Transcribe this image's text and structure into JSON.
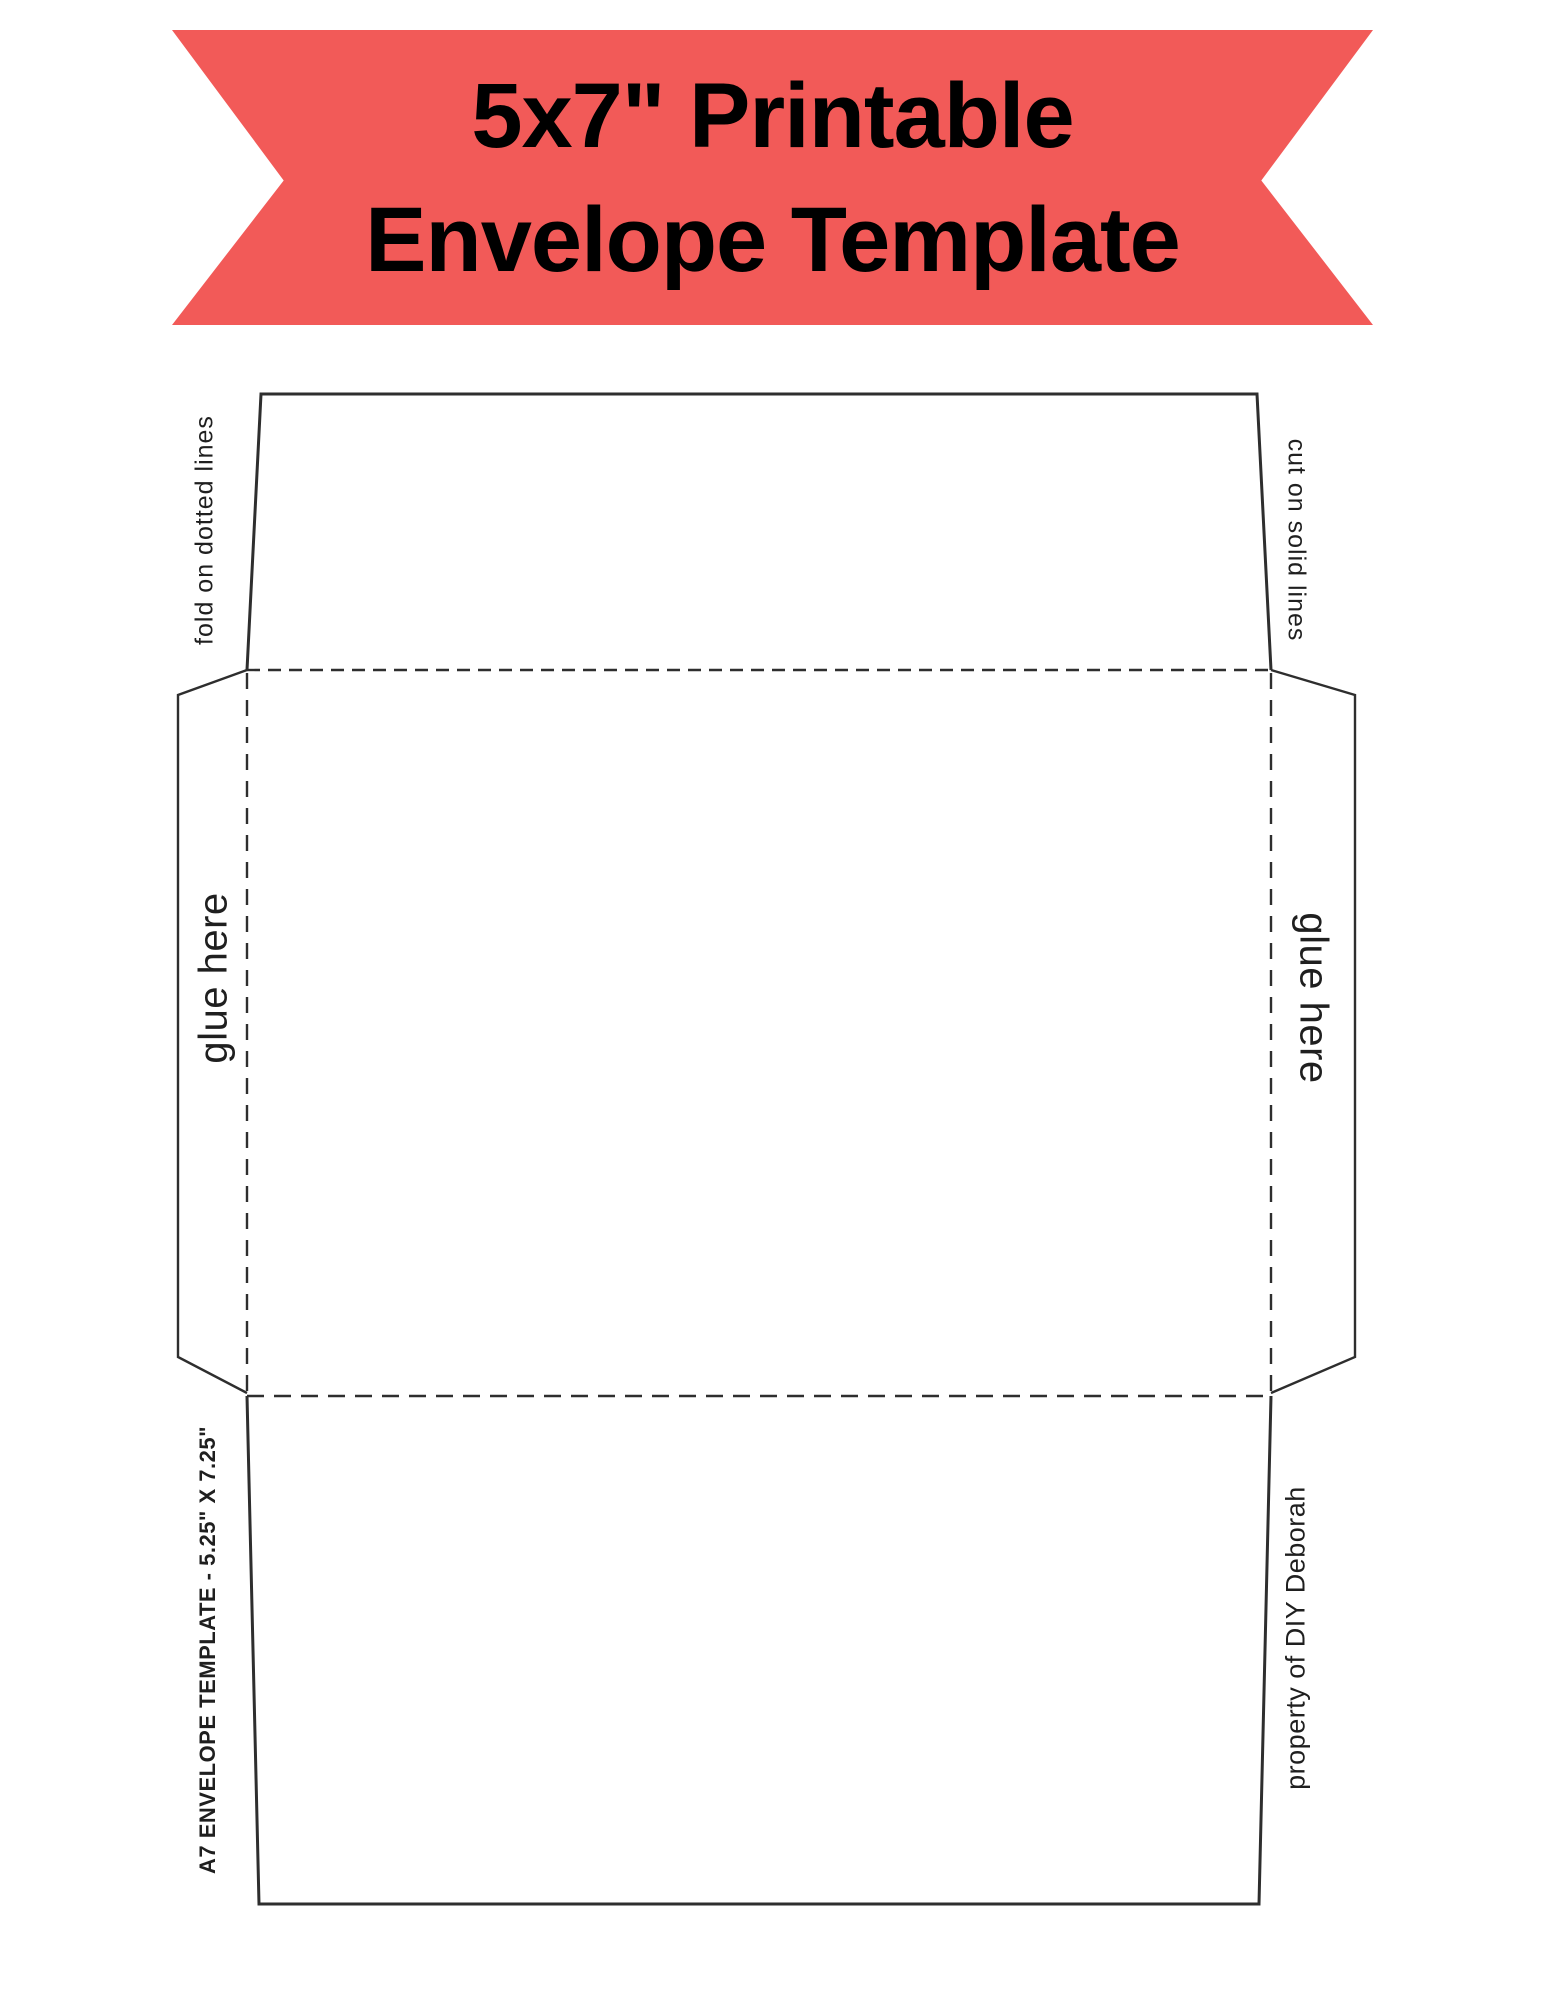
{
  "banner": {
    "line1": "5x7\" Printable",
    "line2": "Envelope Template"
  },
  "labels": {
    "fold_left": "fold on dotted lines",
    "cut_right": "cut on solid lines",
    "glue_left": "glue here",
    "glue_right": "glue here",
    "size_info": "A7 ENVELOPE TEMPLATE - 5.25\" X 7.25\"",
    "credit": "property of DIY Deborah"
  },
  "colors": {
    "banner_background": "#F25A58",
    "banner_text": "#000000",
    "diagram_lines": "#2e2e2e"
  }
}
